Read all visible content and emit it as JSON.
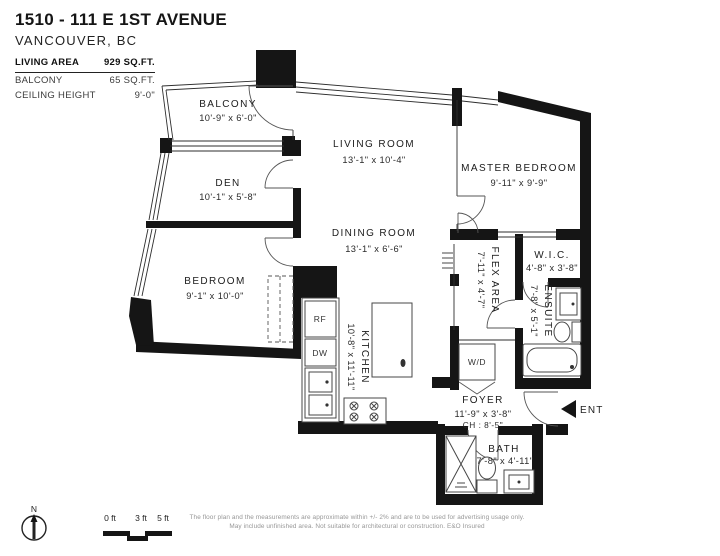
{
  "header": {
    "title": "1510 - 111 E 1ST AVENUE",
    "subtitle": "VANCOUVER, BC",
    "stats": [
      {
        "label": "LIVING AREA",
        "value": "929 SQ.FT."
      },
      {
        "label": "BALCONY",
        "value": "65 SQ.FT."
      },
      {
        "label": "CEILING HEIGHT",
        "value": "9'-0\""
      }
    ]
  },
  "rooms": {
    "balcony": {
      "name": "BALCONY",
      "dims": "10'-9\" x 6'-0\""
    },
    "den": {
      "name": "DEN",
      "dims": "10'-1\" x 5'-8\""
    },
    "living": {
      "name": "LIVING ROOM",
      "dims": "13'-1\" x 10'-4\""
    },
    "dining": {
      "name": "DINING ROOM",
      "dims": "13'-1\" x 6'-6\""
    },
    "master": {
      "name": "MASTER BEDROOM",
      "dims": "9'-11\" x 9'-9\""
    },
    "bedroom": {
      "name": "BEDROOM",
      "dims": "9'-1\" x 10'-0\""
    },
    "kitchen": {
      "name": "KITCHEN",
      "dims": "10'-8\" x 11'-11\""
    },
    "flex": {
      "name": "FLEX AREA",
      "dims": "7'-11\" x 4'-7\""
    },
    "wic": {
      "name": "W.I.C.",
      "dims": "4'-8\" x 3'-8\""
    },
    "ensuite": {
      "name": "ENSUITE",
      "dims": "7'-8\" x 5'-1\""
    },
    "foyer": {
      "name": "FOYER",
      "dims": "11'-9\" x 3'-8\"",
      "ceiling": "CH : 8'-5\""
    },
    "bath": {
      "name": "BATH",
      "dims": "7'-8\" x 4'-11\""
    }
  },
  "appliances": {
    "fridge": "RF",
    "dishwasher": "DW",
    "washer_dryer": "W/D"
  },
  "entry": {
    "label": "ENT"
  },
  "compass": {
    "label": "N"
  },
  "scale_bar": {
    "labels": [
      "0 ft",
      "3 ft",
      "5 ft"
    ]
  },
  "disclaimer": {
    "line1": "The floor plan and the measurements are approximate within +/- 2% and are to be used for advertising usage only.",
    "line2": "May include unfinished area. Not suitable for architectural or construction. E&O Insured"
  },
  "colors": {
    "walls": "#151515",
    "text": "#1c1c1c",
    "muted": "#979797"
  }
}
